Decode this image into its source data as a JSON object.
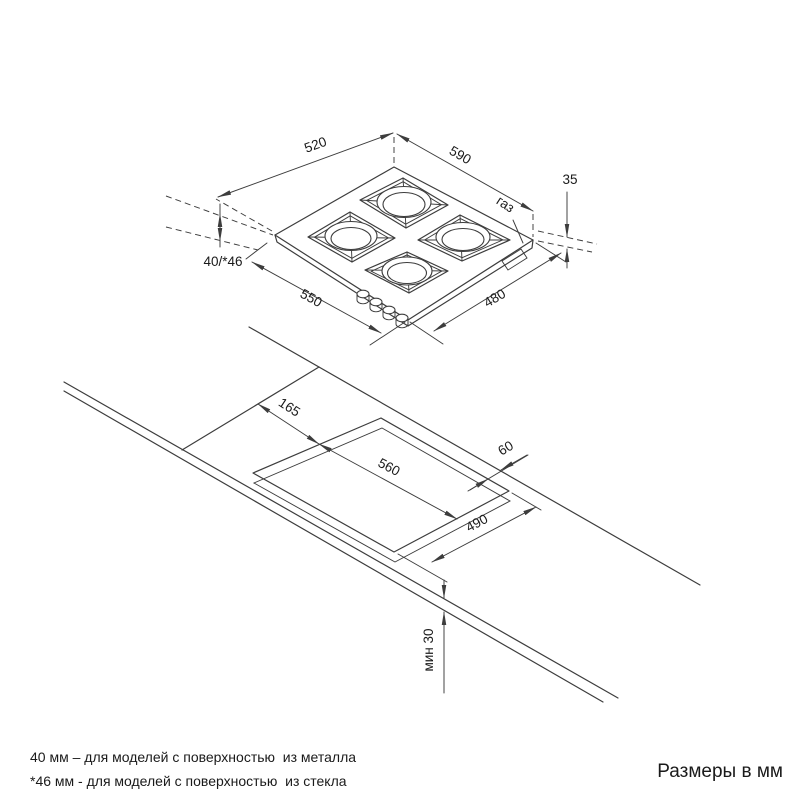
{
  "drawing_title": "Схема установки газовой варочной панели",
  "colors": {
    "line": "#3d3d3d",
    "text": "#1a1a1a",
    "background": "#ffffff"
  },
  "dimensions": {
    "hob": {
      "edge_520": "520",
      "edge_590": "590",
      "height_35": "35",
      "gas_label": "газ",
      "depth_40_46": "40/*46",
      "edge_550": "550",
      "edge_480": "480"
    },
    "cutout": {
      "offset_165": "165",
      "width_560": "560",
      "rear_60": "60",
      "depth_490": "490",
      "min_30": "мин 30"
    }
  },
  "footer": {
    "note_metal": "40 мм – для моделей с поверхностью  из металла",
    "note_glass": "*46 мм - для моделей с поверхностью  из стекла",
    "units": "Размеры в мм"
  }
}
